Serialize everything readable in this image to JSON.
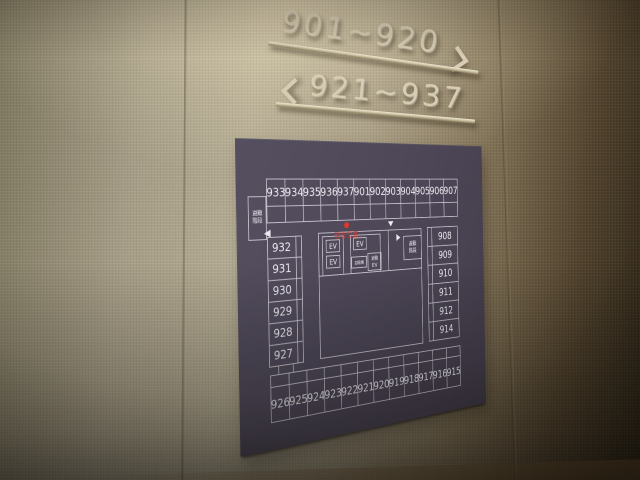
{
  "scene": {
    "wall_signs": {
      "upper": {
        "label": "901~920",
        "arrow": "right"
      },
      "lower": {
        "label": "921~937",
        "arrow": "left"
      }
    }
  },
  "floorplan": {
    "rooms": {
      "top_row": [
        "933",
        "934",
        "935",
        "936",
        "937",
        "901",
        "902",
        "903",
        "904",
        "905",
        "906",
        "907"
      ],
      "left_column": [
        "932",
        "931",
        "930",
        "929",
        "928",
        "927"
      ],
      "right_column": [
        "908",
        "909",
        "910",
        "911",
        "912",
        "914"
      ],
      "bottom_row": [
        "926",
        "925",
        "924",
        "923",
        "922",
        "921",
        "920",
        "919",
        "918",
        "917",
        "916",
        "915"
      ]
    },
    "labels": {
      "evac_stairs_lines": [
        "避難",
        "階段"
      ],
      "elevator": "EV",
      "evac_elevator_lines": [
        "避難",
        "EV"
      ],
      "vending_machine": "自販機",
      "current_location": "現在位置"
    },
    "colors": {
      "panel_bg": "#554f60",
      "panel_bg_dark": "#433d4b",
      "line": "#c9c5ce",
      "room_text": "#edeaf1",
      "marker_red": "#df392e",
      "sign_metal": "#d7cdb4"
    }
  }
}
